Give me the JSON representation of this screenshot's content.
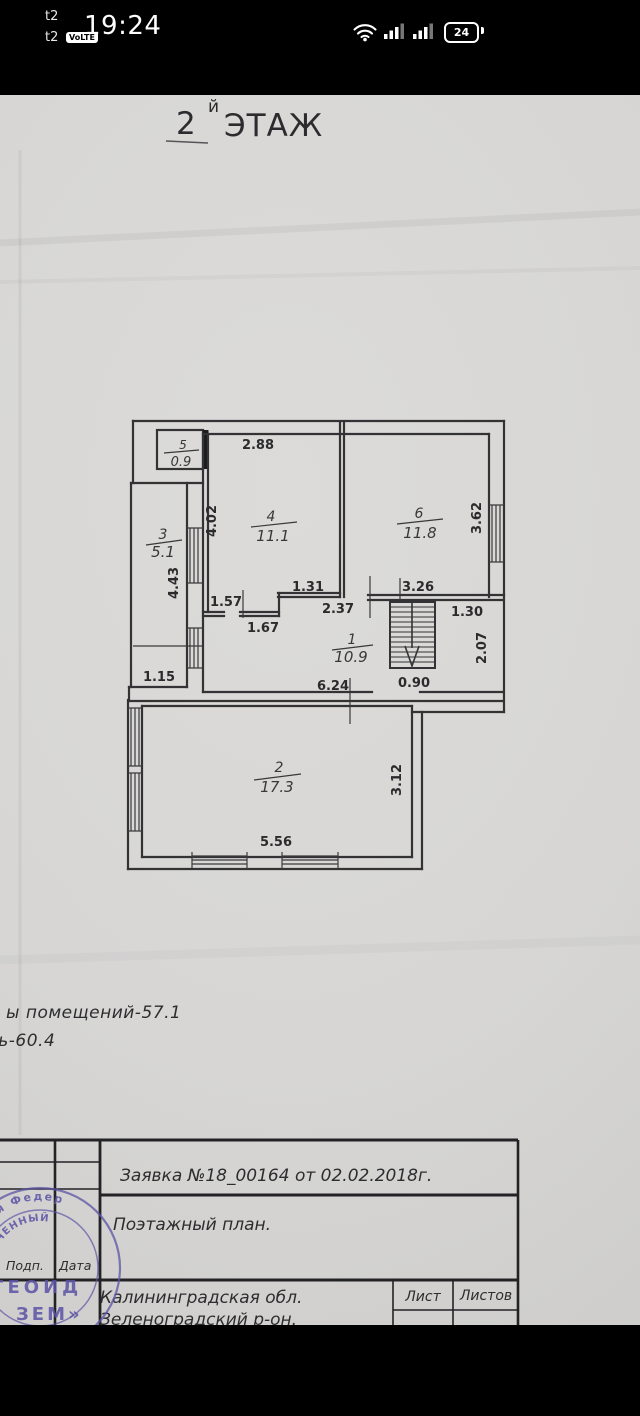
{
  "status_bar": {
    "carrier_primary": "t2",
    "carrier_secondary": "t2",
    "volte": "VoLTE",
    "time": "19:24",
    "battery": "24"
  },
  "photo": {
    "floor_title": {
      "number": "2",
      "suffix": "й",
      "word": "ЭТАЖ"
    },
    "summary_line1": "ы помещений-57.1",
    "summary_line2": "дь-60.4",
    "rooms": [
      {
        "number": "1",
        "area": "10.9"
      },
      {
        "number": "2",
        "area": "17.3"
      },
      {
        "number": "3",
        "area": "5.1"
      },
      {
        "number": "4",
        "area": "11.1"
      },
      {
        "number": "5",
        "area": "0.9"
      },
      {
        "number": "6",
        "area": "11.8"
      }
    ],
    "dimensions": {
      "room4_width": "2.88",
      "room4_height": "4.02",
      "room6_height": "3.62",
      "room3_height": "4.43",
      "hall_seg1": "1.57",
      "hall_seg2": "1.31",
      "room6_bottom": "3.26",
      "hall_seg3": "2.37",
      "hall_seg4": "1.67",
      "stair_right": "1.30",
      "landing_height": "2.07",
      "left_step": "1.15",
      "hall_width": "6.24",
      "stair_width": "0.90",
      "room2_height": "3.12",
      "room2_width": "5.56"
    },
    "title_block": {
      "request": "Заявка №18_00164 от 02.02.2018г.",
      "doc_type": "Поэтажный план.",
      "sign": "Подп.",
      "date": "Дата",
      "region": "Калининградская обл.",
      "district": "Зеленоградский р-он.",
      "sheet": "Лист",
      "sheets": "Листов"
    },
    "stamp": {
      "arc_outer": "йская Федер",
      "arc_inner": "ЧЕННЫЙ",
      "name_line1": "ГЕОИД",
      "name_line2": "ЗЕМ»"
    }
  }
}
